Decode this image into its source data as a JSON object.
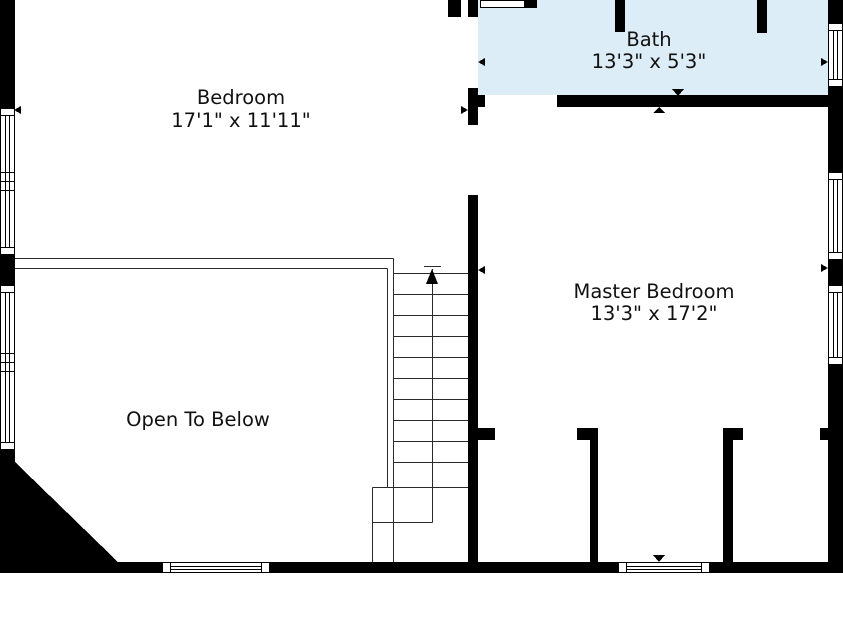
{
  "rooms": {
    "bedroom": {
      "name": "Bedroom",
      "dimensions": "17'1\" x 11'11\""
    },
    "bath": {
      "name": "Bath",
      "dimensions": "13'3\" x 5'3\""
    },
    "master_bedroom": {
      "name": "Master Bedroom",
      "dimensions": "13'3\" x 17'2\""
    },
    "open_to_below": {
      "name": "Open To Below"
    }
  },
  "stairs": {
    "direction_icon": "up-arrow"
  },
  "colors": {
    "wall": "#000000",
    "bath_floor_fill": "#ddedf8",
    "stair_line": "#2a2a2a",
    "background": "#ffffff",
    "label_text": "#111111"
  }
}
